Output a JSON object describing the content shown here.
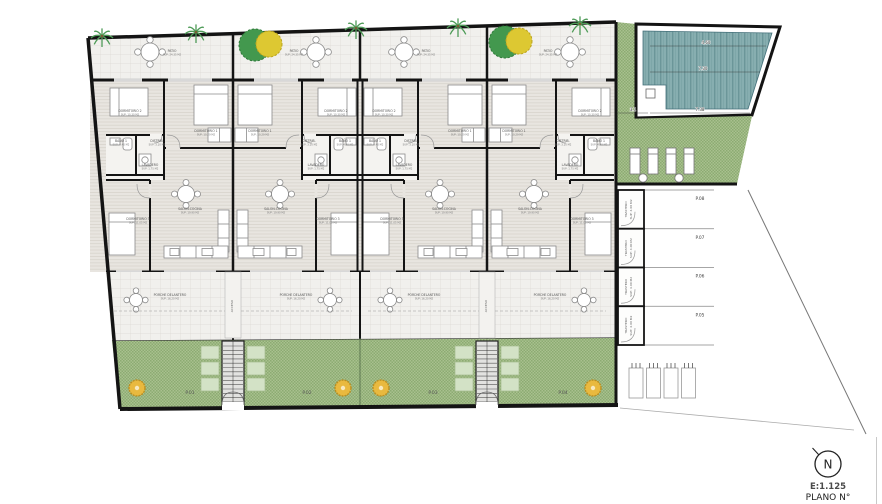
{
  "title_block": {
    "scale": "E:1.125",
    "plano": "PLANO N°",
    "north": "N",
    "scale_color": "#b5952f"
  },
  "rooms": {
    "patio": {
      "name": "PATIO",
      "sup": "SUP: 24.35 M2"
    },
    "dorm2": {
      "name": "DORMITORIO 2",
      "sup": "SUP: 10.30 M2"
    },
    "dorm3": {
      "name": "DORMITORIO 1",
      "sup": "SUP: 10.29 M2"
    },
    "dorm1": {
      "name": "DORMITORIO 3",
      "sup": "SUP: 11.05 M2"
    },
    "bano1": {
      "name": "BAÑO 1",
      "sup": "SUP: 4.40 M2"
    },
    "distrib": {
      "name": "DISTRIB.",
      "sup": "SUP: 3.10 M2"
    },
    "lavadero": {
      "name": "LAVADERO",
      "sup": "SUP: 1.75 M2"
    },
    "salon": {
      "name": "SALON-COCINA",
      "sup": "SUP: 19.90 M2"
    },
    "porche": {
      "name": "PORCHE DELANTERO",
      "sup": "SUP: 16.20 M2"
    }
  },
  "units": [
    {
      "parcel": "P.01"
    },
    {
      "parcel": "P.02"
    },
    {
      "parcel": "P.03"
    },
    {
      "parcel": "P.04"
    }
  ],
  "parking_right": [
    {
      "label": "P.08"
    },
    {
      "label": "P.07"
    },
    {
      "label": "P.06"
    },
    {
      "label": "P.05"
    }
  ],
  "trastero": {
    "label": "TRASTERO",
    "sup": "SUP: 4.00 M2"
  },
  "access": {
    "label": "ACCESO"
  },
  "pool": {
    "dims": {
      "top": "4.60",
      "mid": "7.30",
      "left": "3.1",
      "bottom": "7.38"
    }
  },
  "colors": {
    "wall": "#141414",
    "green_a": "#a9c08f",
    "green_b": "#8cab72",
    "pool_water": "#87aeb0",
    "pool_stripe": "#6b9699",
    "tree_yellow": "#e9b93f",
    "tree_green": "#43984e",
    "tree_canopy_yellow": "#ddc832"
  }
}
